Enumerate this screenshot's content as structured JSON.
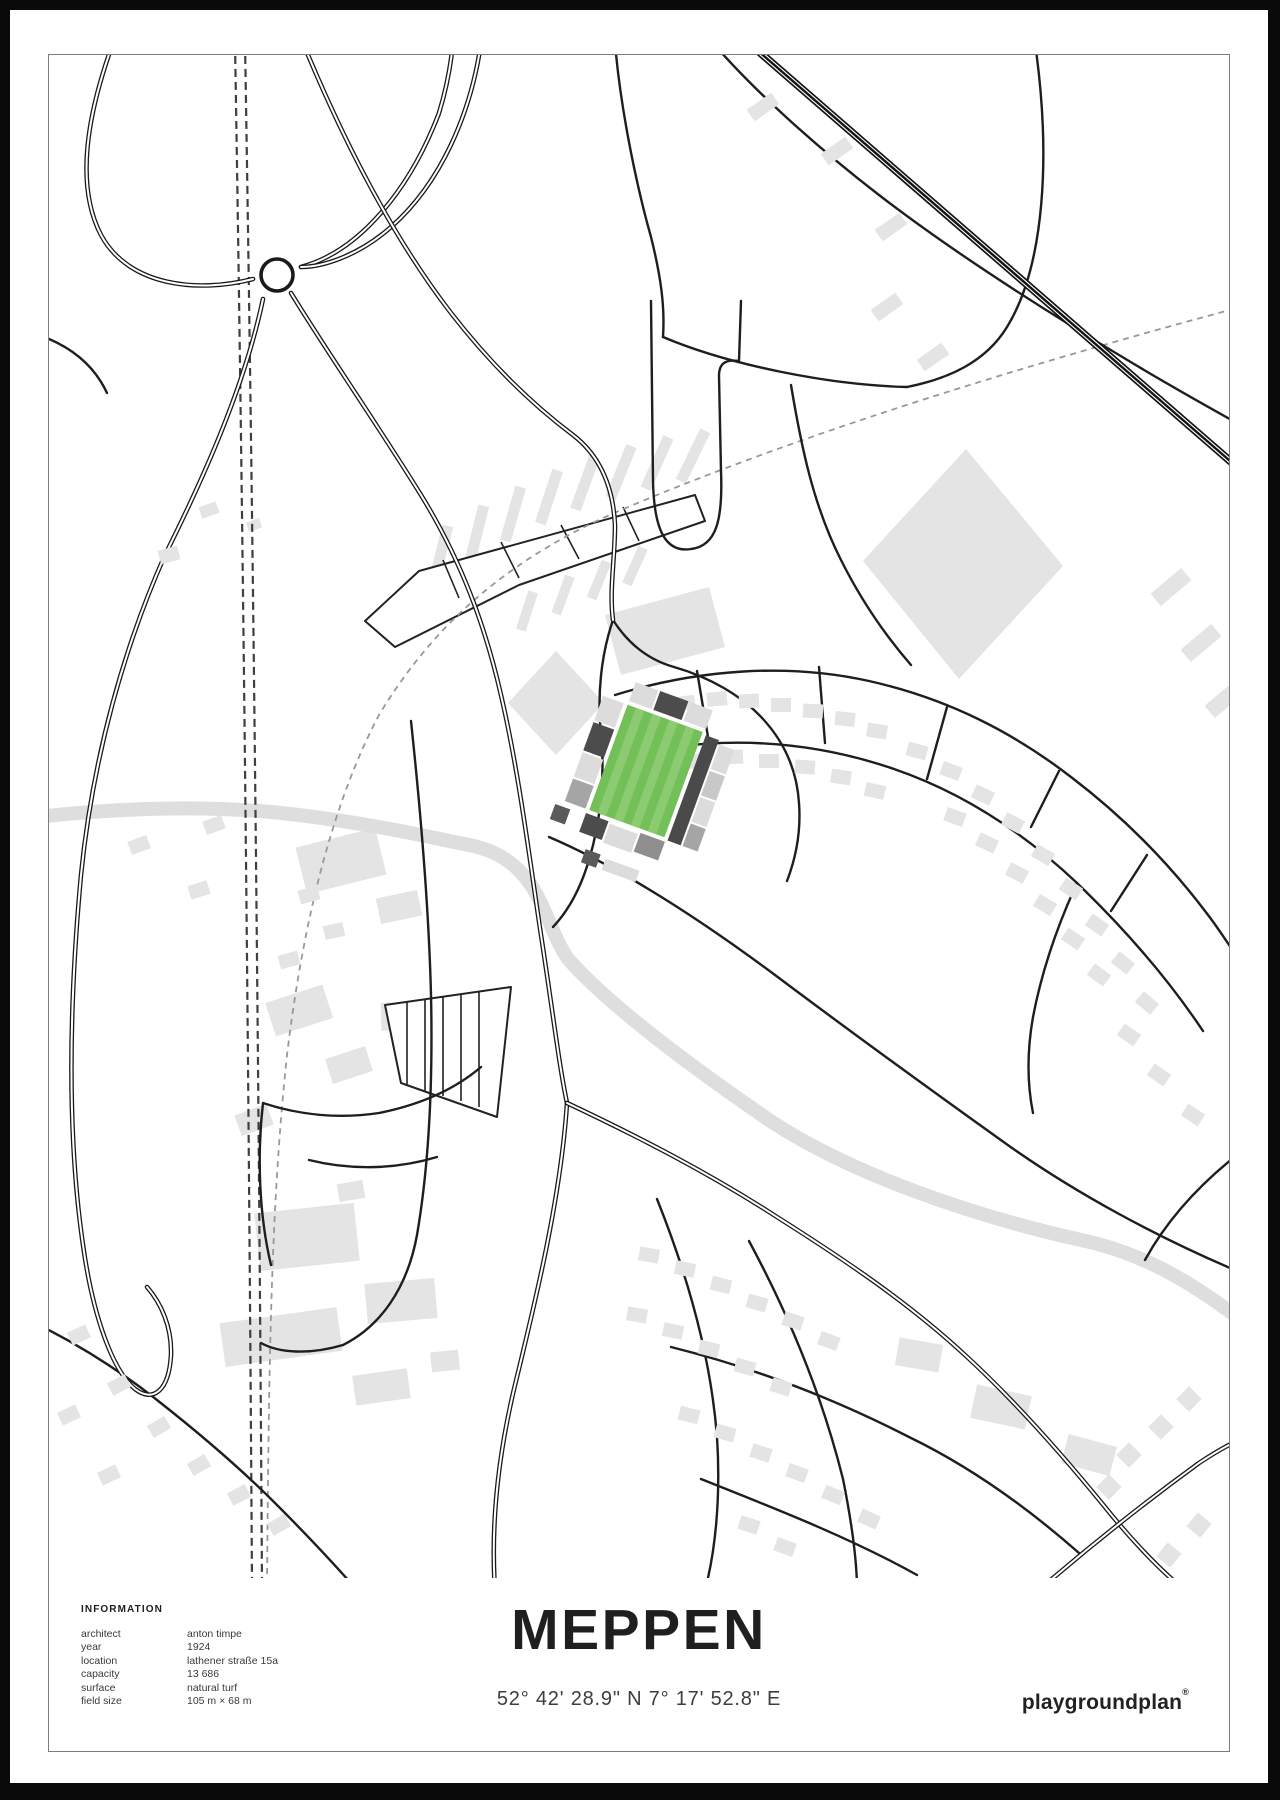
{
  "poster": {
    "title": "MEPPEN",
    "coordinates": "52° 42' 28.9\" N 7° 17' 52.8\" E",
    "brand": {
      "name": "playgroundplan",
      "mark": "®"
    },
    "information": {
      "heading": "INFORMATION",
      "rows": [
        {
          "label": "architect",
          "value": "anton timpe"
        },
        {
          "label": "year",
          "value": "1924"
        },
        {
          "label": "location",
          "value": "lathener straße 15a"
        },
        {
          "label": "capacity",
          "value": "13 686"
        },
        {
          "label": "surface",
          "value": "natural turf"
        },
        {
          "label": "field size",
          "value": "105 m × 68 m"
        }
      ]
    },
    "map_colors": {
      "pitch_green": "#74c058",
      "pitch_stripe": "#8ccb71",
      "stand_dark": "#4c4c4c",
      "stand_mid": "#a5a5a5",
      "stand_light": "#dcdcdc",
      "building_gray": "#e4e4e4",
      "river_gray": "#dedede",
      "road_black": "#1a1a1a",
      "path_dash_gray": "#989898"
    }
  }
}
